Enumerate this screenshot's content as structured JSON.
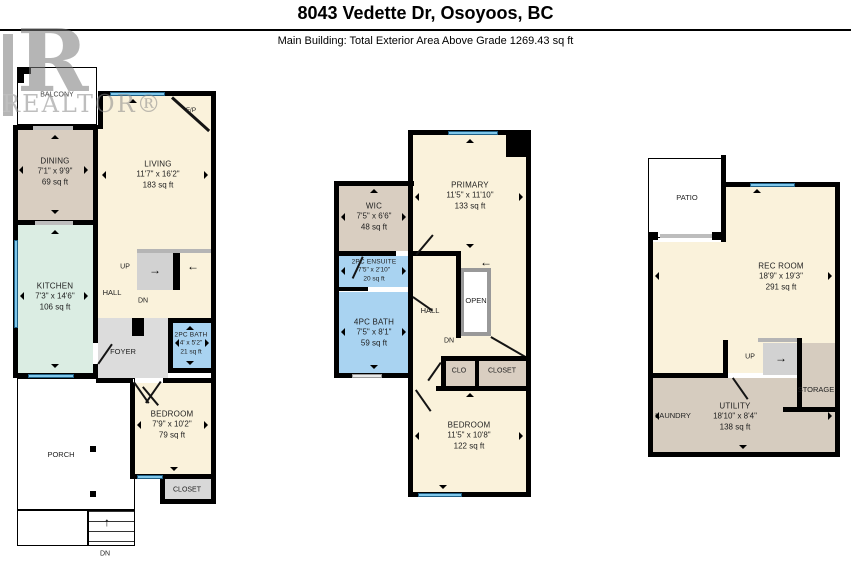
{
  "header": {
    "title": "8043 Vedette Dr, Osoyoos, BC",
    "subtitle": "Main Building: Total Exterior Area Above Grade 1269.43 sq ft"
  },
  "watermark": {
    "letter": "R",
    "text": "REALTOR®"
  },
  "icons": {
    "arrow_right": "→",
    "arrow_left": "←",
    "arrow_up": "↑"
  },
  "palette": {
    "room_cream": "#faf2db",
    "room_tan": "#d9cec1",
    "room_mint": "#dbede3",
    "room_blue": "#a9d3f1",
    "room_gray": "#dcdcdc",
    "stair_gray": "#d2d2d2",
    "window_blue": "#7fc7ea",
    "wall": "#000000"
  },
  "floor_main": {
    "balcony": "BALCONY",
    "fireplace": "F/P",
    "living": {
      "name": "LIVING",
      "dims": "11'7\" x 16'2\"",
      "area": "183 sq ft"
    },
    "dining": {
      "name": "DINING",
      "dims": "7'1\" x 9'9\"",
      "area": "69 sq ft"
    },
    "kitchen": {
      "name": "KITCHEN",
      "dims": "7'3\" x 14'6\"",
      "area": "106 sq ft"
    },
    "hall": "HALL",
    "up": "UP",
    "dn": "DN",
    "foyer": "FOYER",
    "bath": {
      "name": "2PC BATH",
      "dims": "4' x 5'2\"",
      "area": "21 sq ft"
    },
    "bedroom": {
      "name": "BEDROOM",
      "dims": "7'9\" x 10'2\"",
      "area": "79 sq ft"
    },
    "closet": "CLOSET",
    "porch": "PORCH",
    "porch_dn": "DN"
  },
  "floor_upper": {
    "primary": {
      "name": "PRIMARY",
      "dims": "11'5\" x 11'10\"",
      "area": "133 sq ft"
    },
    "wic": {
      "name": "WIC",
      "dims": "7'5\" x 6'6\"",
      "area": "48 sq ft"
    },
    "ensuite": {
      "name": "2PC ENSUITE",
      "dims": "7'5\" x 2'10\"",
      "area": "20 sq ft"
    },
    "bath": {
      "name": "4PC BATH",
      "dims": "7'5\" x 8'1\"",
      "area": "59 sq ft"
    },
    "hall": "HALL",
    "open": "OPEN",
    "dn": "DN",
    "clo": "CLO",
    "closet": "CLOSET",
    "bedroom": {
      "name": "BEDROOM",
      "dims": "11'5\" x 10'8\"",
      "area": "122 sq ft"
    }
  },
  "floor_lower": {
    "patio": "PATIO",
    "rec": {
      "name": "REC ROOM",
      "dims": "18'9\" x 19'3\"",
      "area": "291 sq ft"
    },
    "up": "UP",
    "storage": "STORAGE",
    "laundry": "LAUNDRY",
    "utility": {
      "name": "UTILITY",
      "dims": "18'10\" x 8'4\"",
      "area": "138 sq ft"
    }
  }
}
